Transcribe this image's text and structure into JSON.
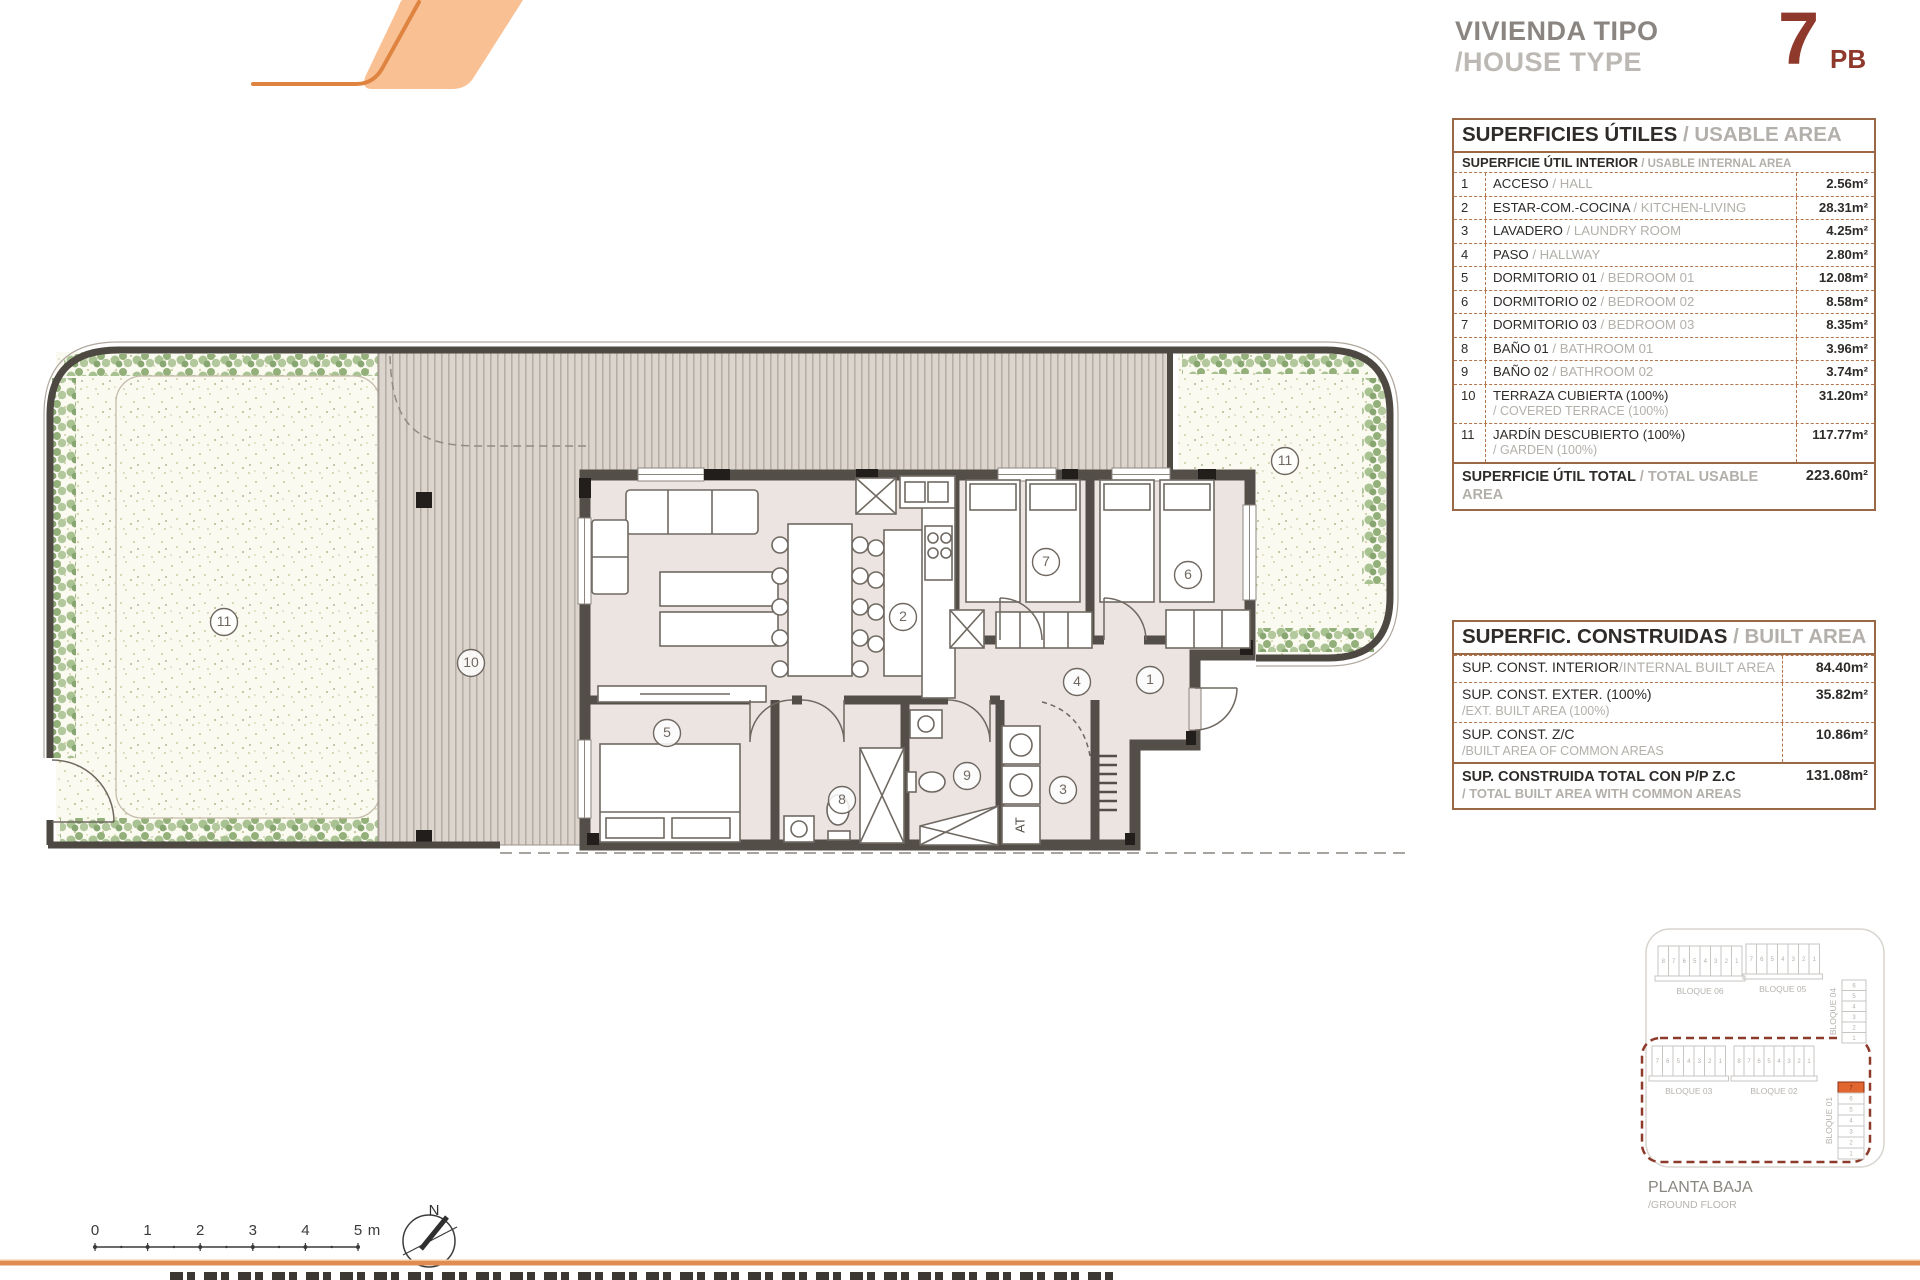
{
  "title": {
    "line1": "VIVIENDA TIPO",
    "line2": "/HOUSE TYPE",
    "type_number": "7",
    "type_suffix": "PB"
  },
  "usable_table": {
    "header_es": "SUPERFICIES ÚTILES",
    "header_en": " / USABLE AREA",
    "subheader_es": "SUPERFICIE ÚTIL INTERIOR",
    "subheader_en": " / USABLE INTERNAL AREA",
    "rows": [
      {
        "num": "1",
        "es": "ACCESO",
        "en": " / HALL",
        "value": "2.56m²",
        "en_block": false
      },
      {
        "num": "2",
        "es": "ESTAR-COM.-COCINA",
        "en": " / KITCHEN-LIVING",
        "value": "28.31m²",
        "en_block": false
      },
      {
        "num": "3",
        "es": "LAVADERO",
        "en": " / LAUNDRY ROOM",
        "value": "4.25m²",
        "en_block": false
      },
      {
        "num": "4",
        "es": "PASO",
        "en": " / HALLWAY",
        "value": "2.80m²",
        "en_block": false
      },
      {
        "num": "5",
        "es": "DORMITORIO 01",
        "en": " / BEDROOM 01",
        "value": "12.08m²",
        "en_block": false
      },
      {
        "num": "6",
        "es": "DORMITORIO 02",
        "en": " / BEDROOM 02",
        "value": "8.58m²",
        "en_block": false
      },
      {
        "num": "7",
        "es": "DORMITORIO 03",
        "en": " / BEDROOM 03",
        "value": "8.35m²",
        "en_block": false
      },
      {
        "num": "8",
        "es": "BAÑO 01",
        "en": " / BATHROOM 01",
        "value": "3.96m²",
        "en_block": false
      },
      {
        "num": "9",
        "es": "BAÑO 02",
        "en": " / BATHROOM 02",
        "value": "3.74m²",
        "en_block": false
      },
      {
        "num": "10",
        "es": "TERRAZA CUBIERTA (100%)",
        "en": "/ COVERED TERRACE (100%)",
        "value": "31.20m²",
        "en_block": true
      },
      {
        "num": "11",
        "es": "JARDÍN DESCUBIERTO (100%)",
        "en": "/ GARDEN (100%)",
        "value": "117.77m²",
        "en_block": true
      }
    ],
    "total_es": "SUPERFICIE ÚTIL TOTAL",
    "total_en": " / TOTAL USABLE AREA",
    "total_value": "223.60m²"
  },
  "built_table": {
    "header_es": "SUPERFIC. CONSTRUIDAS",
    "header_en": " / BUILT AREA",
    "rows": [
      {
        "es": "SUP. CONST. INTERIOR",
        "en": "/INTERNAL BUILT AREA",
        "value": "84.40m²",
        "en_block": false
      },
      {
        "es": "SUP. CONST. EXTER. (100%)",
        "en": "/EXT. BUILT AREA (100%)",
        "value": "35.82m²",
        "en_block": true
      },
      {
        "es": "SUP. CONST. Z/C",
        "en": "/BUILT AREA OF COMMON AREAS",
        "value": "10.86m²",
        "en_block": true
      }
    ],
    "total_es": "SUP. CONSTRUIDA TOTAL CON P/P Z.C",
    "total_en": "/ TOTAL BUILT AREA WITH COMMON AREAS",
    "total_value": "131.08m²"
  },
  "plan": {
    "at_label": "AT",
    "room_labels": [
      {
        "n": "1",
        "x": 1150,
        "y": 680
      },
      {
        "n": "2",
        "x": 903,
        "y": 617
      },
      {
        "n": "3",
        "x": 1063,
        "y": 790
      },
      {
        "n": "4",
        "x": 1077,
        "y": 682
      },
      {
        "n": "5",
        "x": 667,
        "y": 733
      },
      {
        "n": "6",
        "x": 1188,
        "y": 575
      },
      {
        "n": "7",
        "x": 1046,
        "y": 562
      },
      {
        "n": "8",
        "x": 842,
        "y": 800
      },
      {
        "n": "9",
        "x": 967,
        "y": 776
      },
      {
        "n": "10",
        "x": 471,
        "y": 663
      },
      {
        "n": "11",
        "x": 224,
        "y": 622
      },
      {
        "n": "11",
        "x": 1285,
        "y": 461
      }
    ]
  },
  "keyplan": {
    "caption_line1": "PLANTA BAJA",
    "caption_line2": "/GROUND FLOOR",
    "highlight_unit": "7",
    "blocks": [
      {
        "name": "BLOQUE 06",
        "orient": "h",
        "units": [
          "8",
          "7",
          "6",
          "5",
          "4",
          "3",
          "2",
          "1"
        ],
        "x": 1658,
        "y": 946,
        "cw": 10.5,
        "ch": 30
      },
      {
        "name": "BLOQUE 05",
        "orient": "h",
        "units": [
          "7",
          "6",
          "5",
          "4",
          "3",
          "2",
          "1"
        ],
        "x": 1746,
        "y": 944,
        "cw": 10.5,
        "ch": 30
      },
      {
        "name": "BLOQUE 04",
        "orient": "v",
        "units": [
          "6",
          "5",
          "4",
          "3",
          "2",
          "1"
        ],
        "x": 1842,
        "y": 980,
        "cw": 24,
        "ch": 10.5
      },
      {
        "name": "BLOQUE 03",
        "orient": "h",
        "units": [
          "7",
          "6",
          "5",
          "4",
          "3",
          "2",
          "1"
        ],
        "x": 1652,
        "y": 1046,
        "cw": 10.5,
        "ch": 30
      },
      {
        "name": "BLOQUE 02",
        "orient": "h",
        "units": [
          "8",
          "7",
          "6",
          "5",
          "4",
          "3",
          "2",
          "1"
        ],
        "x": 1734,
        "y": 1046,
        "cw": 10,
        "ch": 30
      },
      {
        "name": "BLOQUE 01",
        "orient": "v",
        "units": [
          "7",
          "6",
          "5",
          "4",
          "3",
          "2",
          "1"
        ],
        "x": 1838,
        "y": 1082,
        "cw": 26,
        "ch": 11,
        "highlight": true
      }
    ]
  },
  "scalebar": {
    "labels": [
      "0",
      "1",
      "2",
      "3",
      "4",
      "5"
    ],
    "unit": "m"
  },
  "north_label": "N",
  "colors": {
    "accent_orange": "#E08440",
    "logo_fill": "#F9C094",
    "maroon": "#8E392B",
    "highlight_orange": "#E2662F",
    "wall": "#544E48",
    "dashed_border": "#B5764D",
    "solid_border": "#9A6845"
  }
}
